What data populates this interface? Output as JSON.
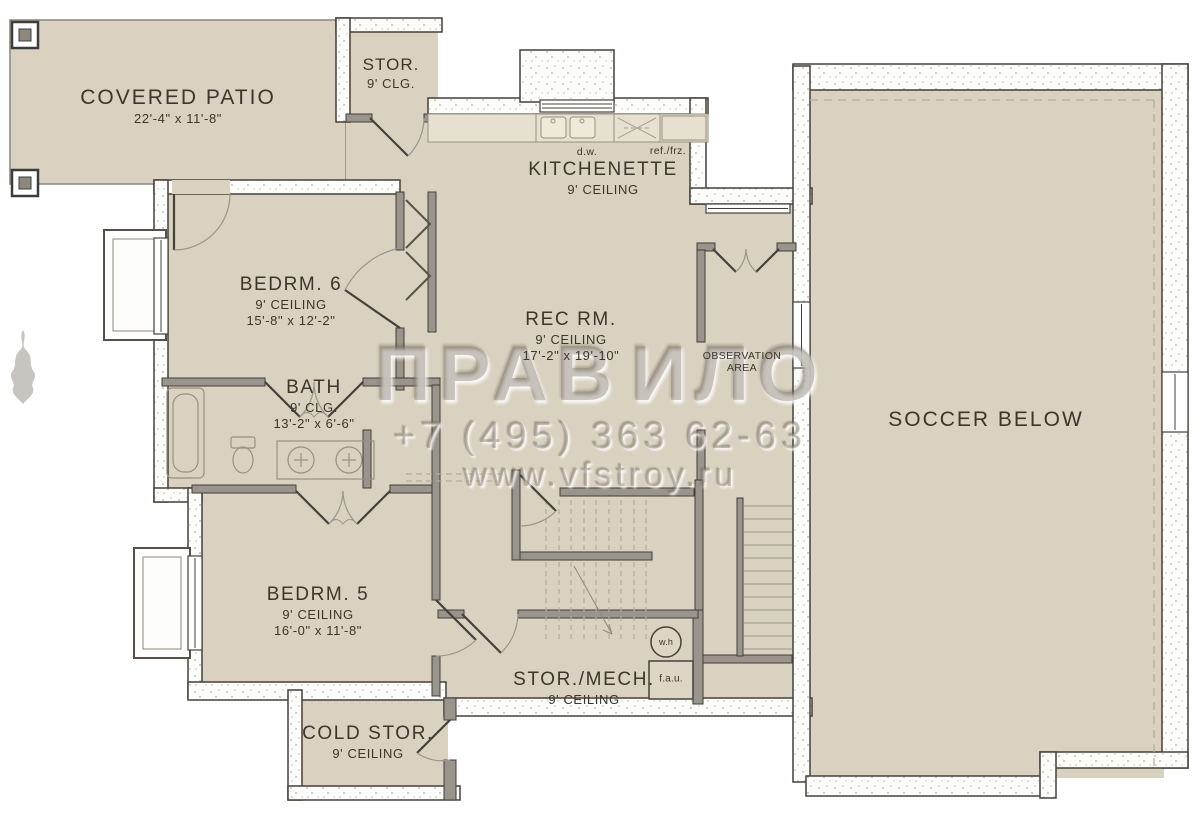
{
  "rooms": {
    "covered_patio": {
      "name": "COVERED PATIO",
      "dims": "22'-4\" x 11'-8\""
    },
    "stor_top": {
      "name": "STOR.",
      "ceiling": "9' CLG."
    },
    "kitchenette": {
      "name": "KITCHENETTE",
      "ceiling": "9' CEILING"
    },
    "bedrm6": {
      "name": "BEDRM. 6",
      "ceiling": "9' CEILING",
      "dims": "15'-8\" x 12'-2\""
    },
    "rec_rm": {
      "name": "REC RM.",
      "ceiling": "9' CEILING",
      "dims": "17'-2\" x 19'-10\""
    },
    "observation": {
      "line1": "OBSERVATION",
      "line2": "AREA"
    },
    "bath": {
      "name": "BATH",
      "ceiling": "9' CLG.",
      "dims": "13'-2\" x 6'-6\""
    },
    "bedrm5": {
      "name": "BEDRM. 5",
      "ceiling": "9' CEILING",
      "dims": "16'-0\" x 11'-8\""
    },
    "cold_stor": {
      "name": "COLD STOR.",
      "ceiling": "9' CEILING"
    },
    "stor_mech": {
      "name": "STOR./MECH.",
      "ceiling": "9' CEILING"
    },
    "soccer": {
      "name": "SOCCER BELOW"
    }
  },
  "appliances": {
    "dw": "d.w.",
    "ref": "ref./frz.",
    "wh": "w.h",
    "fau": "f.a.u."
  },
  "watermark": {
    "brand_left": "ПРАВ",
    "brand_right": "ИЛО",
    "phone": "+7 (495) 363 62-63",
    "website": "www.vfstroy.ru"
  },
  "colors": {
    "floor": "#d9d2c0",
    "wall_gray": "#9a958c",
    "wall_dark": "#45403a",
    "text": "#3c362c",
    "watermark": "#7a6f5e"
  }
}
